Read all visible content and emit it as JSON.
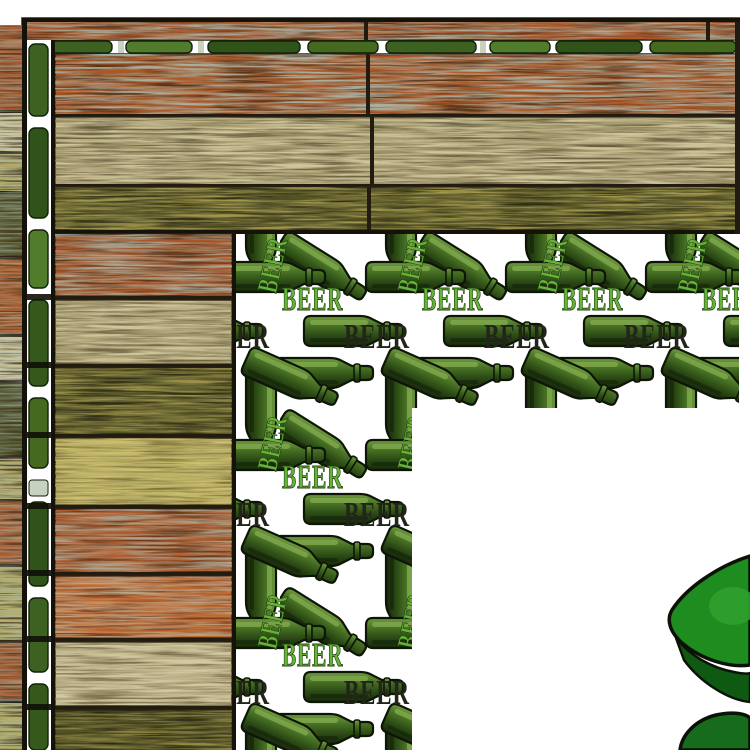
{
  "image": {
    "pattern": {
      "label": "BEER",
      "green_text": "#64b437",
      "dark_text": "#23251b",
      "bottle_light": "#6f9a40",
      "bottle_mid": "#4a7526",
      "bottle_dark": "#2e4f15",
      "background": "#ffffff"
    },
    "wood": {
      "rust": "#a8562a",
      "rust2": "#ab5828",
      "tan": "#cfc49a",
      "olive": "#56552a",
      "yellow": "#b3a964",
      "orange": "#b05c2e",
      "orange2": "#c06a32",
      "cream": "#d2c8a2",
      "olive2": "#4f4f26",
      "teal_streak": "#a9c0b6",
      "seam": "#221c10",
      "edge": "#151209"
    },
    "cartoon": {
      "bright_green": "#1f8c1f",
      "mid_green": "#176b1c",
      "dark_green": "#0e5a13",
      "outline": "#0c1208"
    }
  }
}
